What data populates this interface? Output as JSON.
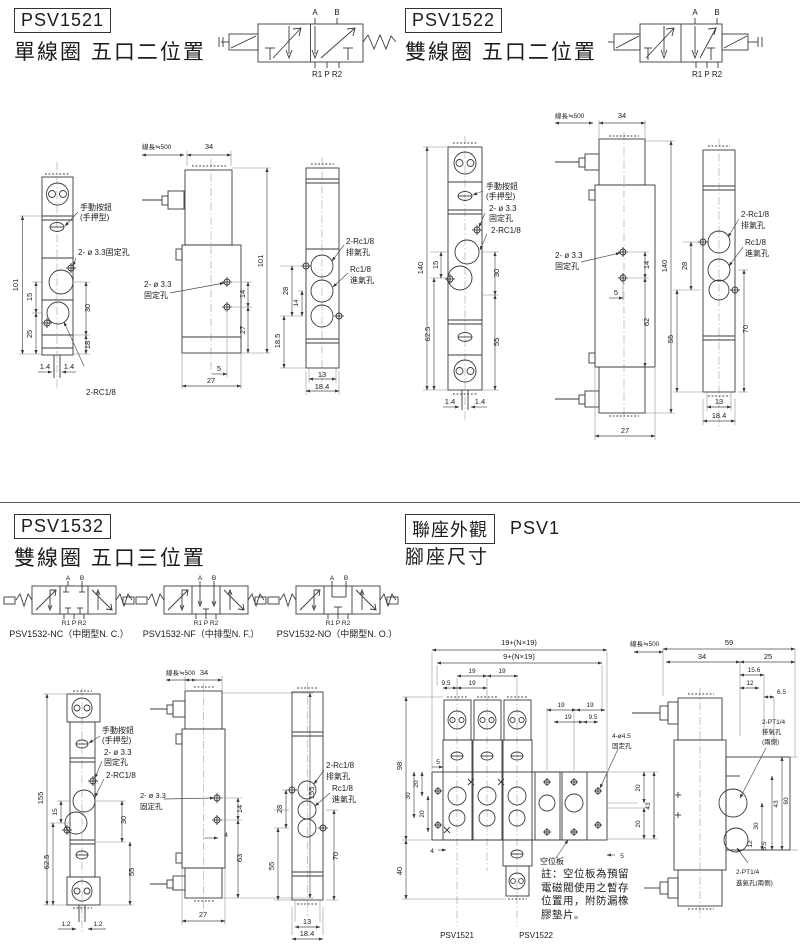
{
  "psv1521": {
    "model": "PSV1521",
    "subtitle": "單線圈 五口二位置",
    "symbol": {
      "a": "A",
      "b": "B",
      "bottom": "R1 P R2"
    },
    "front": {
      "btn1": "手動按鈕",
      "btn2": "(手押型)",
      "fix": "2- ø 3.3固定孔",
      "rc": "2-RC1/8",
      "h": "101",
      "d15": "15",
      "d25": "25",
      "d30": "30",
      "d18": "18",
      "bl": "1.4",
      "br": "1.4"
    },
    "side": {
      "wire": "線長≒500",
      "w": "34",
      "h": "101",
      "fix1": "2- ø 3.3",
      "fix2": "固定孔",
      "d14": "14",
      "d27": "27",
      "d5": "5",
      "wb": "27"
    },
    "back": {
      "ex1": "2-Rc1/8",
      "ex2": "排氣孔",
      "in1": "Rc1/8",
      "in2": "進氣孔",
      "d28": "28",
      "d14": "14",
      "d185": "18.5",
      "d13": "13",
      "d184": "18.4"
    }
  },
  "psv1522": {
    "model": "PSV1522",
    "subtitle": "雙線圈 五口二位置",
    "symbol": {
      "a": "A",
      "b": "B",
      "bottom": "R1 P R2"
    },
    "front": {
      "btn1": "手動按鈕",
      "btn2": "(手押型)",
      "fix1": "2- ø 3.3",
      "fix2": "固定孔",
      "rc": "2-RC1/8",
      "h": "140",
      "d15": "15",
      "d625": "62.5",
      "d30": "30",
      "d55": "55",
      "bl": "1.4",
      "br": "1.4"
    },
    "side": {
      "wire": "線長≒500",
      "w": "34",
      "h": "140",
      "fix1": "2- ø 3.3",
      "fix2": "固定孔",
      "d14": "14",
      "d5": "5",
      "d62": "62",
      "wb": "27"
    },
    "back": {
      "ex1": "2-Rc1/8",
      "ex2": "排氣孔",
      "in1": "Rc1/8",
      "in2": "進氣孔",
      "d28": "28",
      "d55": "55",
      "d70": "70",
      "d13": "13",
      "d184": "18.4"
    }
  },
  "psv1532": {
    "model": "PSV1532",
    "subtitle": "雙線圈 五口三位置",
    "symbol": {
      "a": "A",
      "b": "B",
      "bottom": "R1 P R2"
    },
    "variants": [
      {
        "caption": "PSV1532-NC（中閉型N. C.）"
      },
      {
        "caption": "PSV1532-NF（中排型N. F.）"
      },
      {
        "caption": "PSV1532-NO（中開型N. O.）"
      }
    ],
    "front": {
      "btn1": "手動按鈕",
      "btn2": "(手押型)",
      "fix1": "2- ø 3.3",
      "fix2": "固定孔",
      "rc": "2-RC1/8",
      "h": "155",
      "d15": "15",
      "d625": "62.5",
      "d30": "30",
      "d55": "55",
      "bl": "1.2",
      "br": "1.2"
    },
    "side": {
      "wire": "線長≒500",
      "w": "34",
      "h": "155",
      "fix1": "2- ø 3.3",
      "fix2": "固定孔",
      "d14": "14",
      "d4": "4",
      "d63": "63",
      "wb": "27"
    },
    "back": {
      "ex1": "2-Rc1/8",
      "ex2": "排氣孔",
      "in1": "Rc1/8",
      "in2": "進氣孔",
      "d28": "28",
      "d55": "55",
      "d70": "70",
      "d13": "13",
      "d184": "18.4"
    }
  },
  "manifold": {
    "title": "聯座外觀",
    "model": "PSV1",
    "subtitle": "腳座尺寸",
    "top1": "19+(N×19)",
    "top2": "9+(N×19)",
    "d19": "19",
    "d95": "9.5",
    "fix1": "4-ø4.5",
    "fix2": "固定孔",
    "spare": "空位板",
    "d98": "98",
    "d40": "40",
    "d5": "5",
    "d20": "20",
    "d30": "30",
    "d4": "4",
    "d43": "43",
    "d5b": "5",
    "v1": "PSV1521",
    "v2": "PSV1522",
    "note": [
      "註：空位板為預留",
      "電磁閥使用之暫存",
      "位置用，附防漏橡",
      "膠墊片。"
    ],
    "side": {
      "wire": "線長≒500",
      "d59": "59",
      "d34": "34",
      "d25": "25",
      "d156": "15.6",
      "d12": "12",
      "d65": "6.5",
      "ex1": "2-PT1/4",
      "ex2": "排氣孔",
      "ex3": "(兩側)",
      "in1": "2-PT1/4",
      "in2": "進氣孔(兩側)",
      "d43": "43",
      "d60": "60",
      "d30": "30",
      "d12b": "12",
      "d85": "8.5"
    }
  }
}
